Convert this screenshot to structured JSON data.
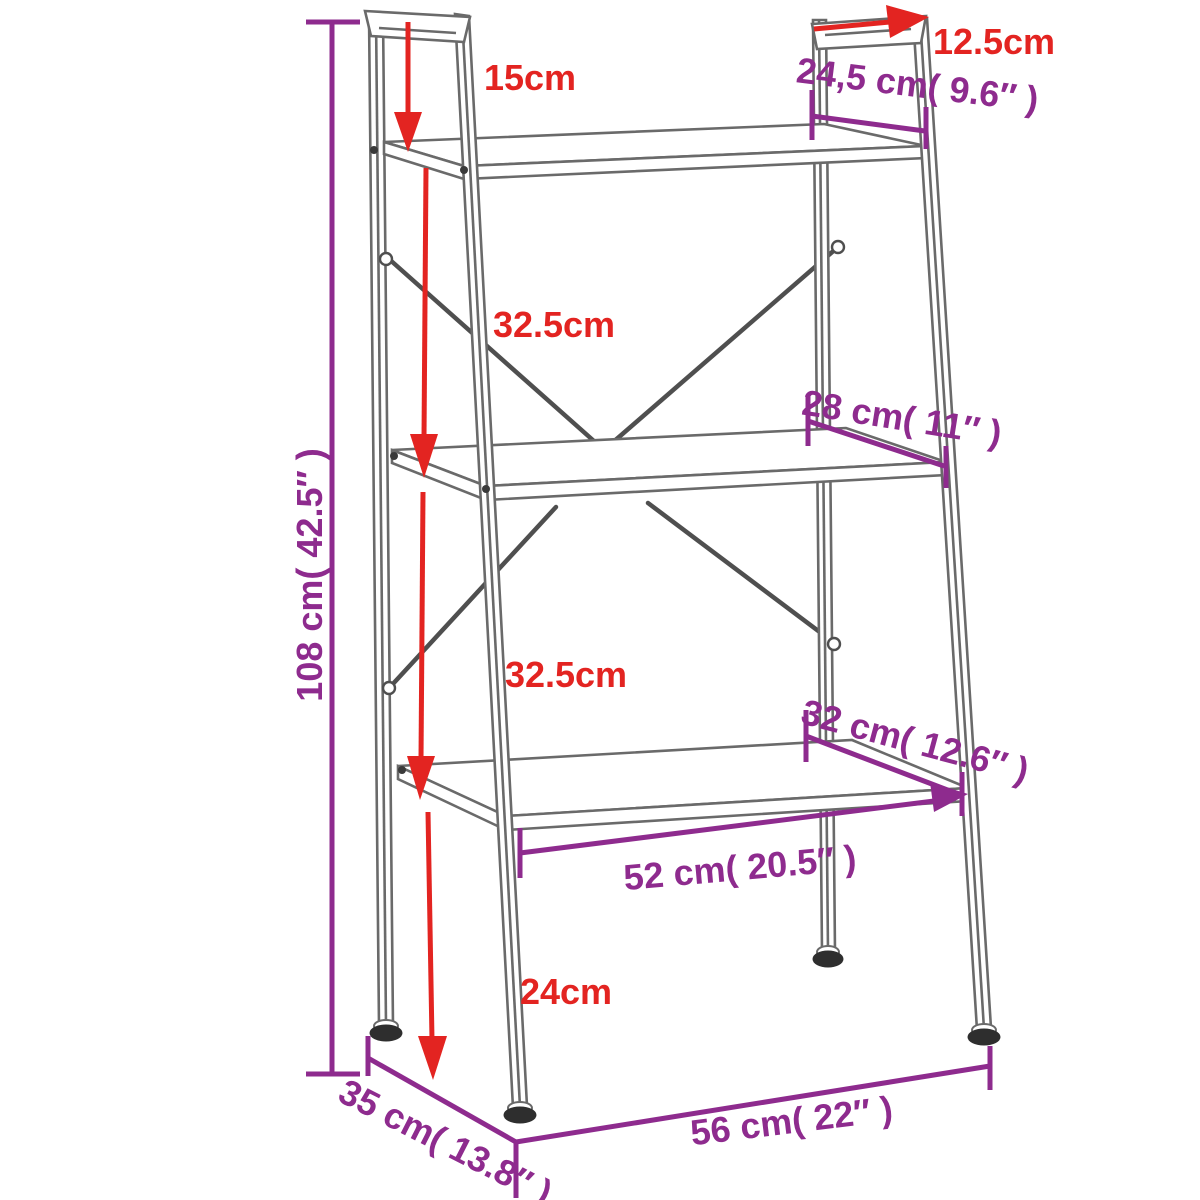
{
  "page": {
    "background": "#ffffff"
  },
  "diagram": {
    "subject": "3-tier ladder shelf dimension drawing",
    "colors": {
      "red_dimension": "#e32421",
      "purple_dimension": "#8e2b8e",
      "outline_gray": "#6a6a6a"
    },
    "labels": {
      "top_clearance": "15cm",
      "top_bar_depth": "12.5cm",
      "top_shelf_depth": "24,5 cm( 9.6″ )",
      "overall_height": "108 cm( 42.5″ )",
      "shelf1_to_shelf2": "32.5cm",
      "middle_shelf_depth": "28 cm( 11″ )",
      "shelf2_to_shelf3": "32.5cm",
      "bottom_shelf_depth": "32 cm( 12.6″ )",
      "bottom_shelf_width": "52 cm( 20.5″ )",
      "ground_clearance": "24cm",
      "base_depth": "35 cm( 13.8″ )",
      "base_width": "56 cm( 22″ )"
    }
  }
}
